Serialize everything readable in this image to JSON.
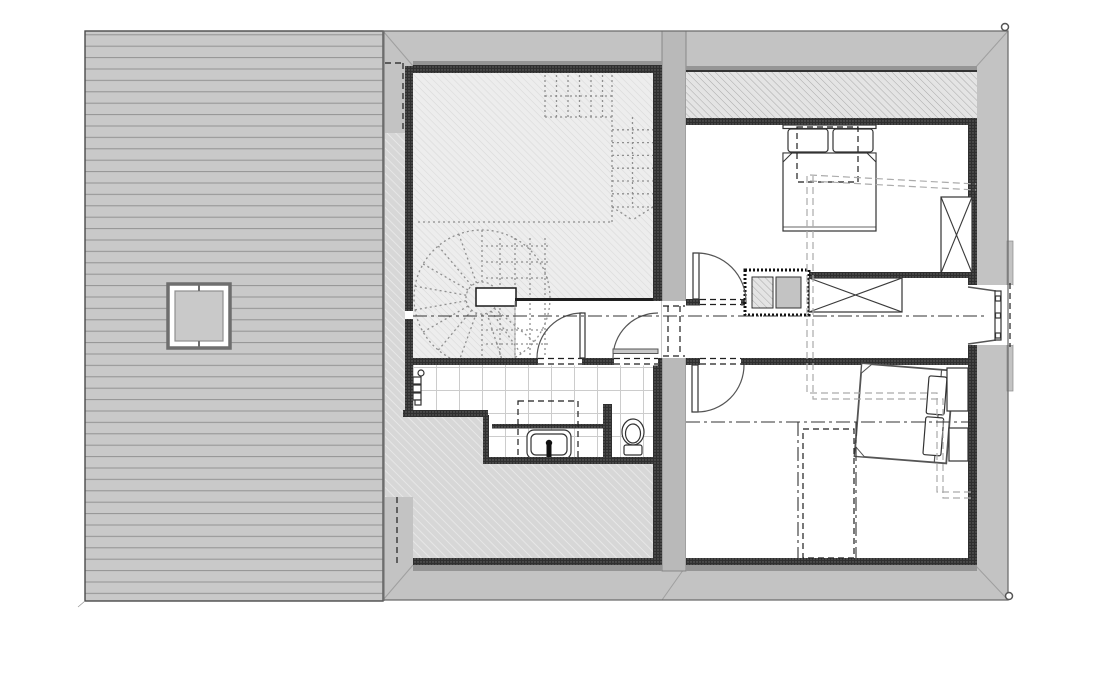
{
  "canvas": {
    "width": 1100,
    "height": 700
  },
  "title_note": "",
  "colors": {
    "background": "#ffffff",
    "deck_fill": "#c9c9c9",
    "deck_line": "#929292",
    "deck_outline": "#4a4a4a",
    "roof_band": "#c3c3c3",
    "roof_outline": "#6f6f6f",
    "miter_line": "#9f9f9f",
    "wall_dark": "#2f2f2f",
    "wall_stipple_dot": "#6a6a6a",
    "wall_strip": "#959595",
    "party_wall": "#b9b9b9",
    "room_hatch_bg": "#ededed",
    "room_hatch_line": "#dadada",
    "underroof_bg": "#d7d7d7",
    "underroof_line": "#ececec",
    "knee_bg": "#e4e4e4",
    "knee_line": "#a9a9a9",
    "tile_bg": "#ffffff",
    "tile_line": "#cccccc",
    "fixture_stroke": "#333333",
    "door_stroke": "#555555",
    "centerline": "#333333",
    "stair_dot": "#8f8f8f",
    "dash_black": "#1f1f1f",
    "projection_dash": "#ababab",
    "skylight_frame": "#6e6e6e",
    "accent_green": "#2f9e2f",
    "marker_stroke": "#555555"
  },
  "icons": {
    "corner-marker": "small circle survey point",
    "wardrobe-x": "rectangle with diagonal cross",
    "door-swing": "quarter-circle arc",
    "stair-arrow": "V arrowhead at stair foot"
  }
}
